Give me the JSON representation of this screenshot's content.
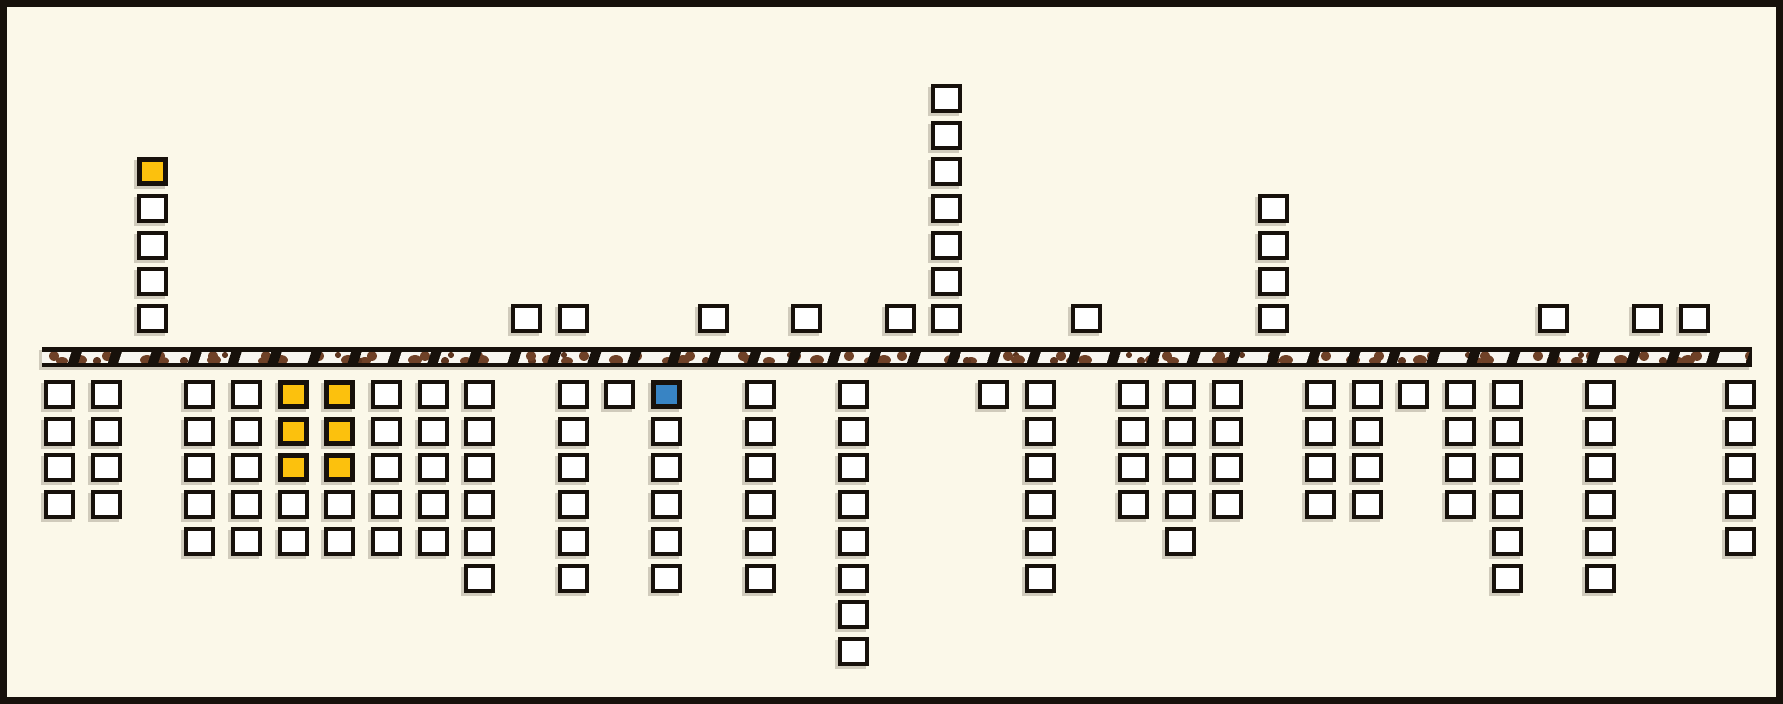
{
  "canvas": {
    "width": 1783,
    "height": 704,
    "background": "#FBF8E9",
    "frame_color": "#17110B",
    "frame_width": 7
  },
  "band": {
    "x": 35,
    "y": 340,
    "width": 1710,
    "height": 20,
    "fill": "#F8F6F0",
    "dot_color": "#6F4127",
    "dot_color_dark": "#5E3620",
    "dash_color": "#17110B"
  },
  "grid": {
    "origin_x": 37,
    "col_pitch": 46.7,
    "row_pitch": 36.7,
    "cell_w": 31,
    "cell_h": 29,
    "above_first_row_top": 297,
    "below_first_row_top": 373
  },
  "colors": {
    "W": "#FFFFFF",
    "Y": "#FCC10D",
    "B": "#3884C4"
  },
  "columns": [
    {
      "col": 0,
      "above": [],
      "below": [
        "W",
        "W",
        "W",
        "W"
      ]
    },
    {
      "col": 1,
      "above": [],
      "below": [
        "W",
        "W",
        "W",
        "W"
      ]
    },
    {
      "col": 2,
      "above": [
        "W",
        "W",
        "W",
        "W",
        "Y"
      ],
      "below": []
    },
    {
      "col": 3,
      "above": [],
      "below": [
        "W",
        "W",
        "W",
        "W",
        "W"
      ]
    },
    {
      "col": 4,
      "above": [],
      "below": [
        "W",
        "W",
        "W",
        "W",
        "W"
      ]
    },
    {
      "col": 5,
      "above": [],
      "below": [
        "Y",
        "Y",
        "Y",
        "W",
        "W"
      ]
    },
    {
      "col": 6,
      "above": [],
      "below": [
        "Y",
        "Y",
        "Y",
        "W",
        "W"
      ]
    },
    {
      "col": 7,
      "above": [],
      "below": [
        "W",
        "W",
        "W",
        "W",
        "W"
      ]
    },
    {
      "col": 8,
      "above": [],
      "below": [
        "W",
        "W",
        "W",
        "W",
        "W"
      ]
    },
    {
      "col": 9,
      "above": [],
      "below": [
        "W",
        "W",
        "W",
        "W",
        "W",
        "W"
      ]
    },
    {
      "col": 10,
      "above": [
        "W"
      ],
      "below": []
    },
    {
      "col": 11,
      "above": [
        "W"
      ],
      "below": [
        "W",
        "W",
        "W",
        "W",
        "W",
        "W"
      ]
    },
    {
      "col": 12,
      "above": [],
      "below": [
        "W"
      ]
    },
    {
      "col": 13,
      "above": [],
      "below": [
        "B",
        "W",
        "W",
        "W",
        "W",
        "W"
      ]
    },
    {
      "col": 14,
      "above": [
        "W"
      ],
      "below": []
    },
    {
      "col": 15,
      "above": [],
      "below": [
        "W",
        "W",
        "W",
        "W",
        "W",
        "W"
      ]
    },
    {
      "col": 16,
      "above": [
        "W"
      ],
      "below": []
    },
    {
      "col": 17,
      "above": [],
      "below": [
        "W",
        "W",
        "W",
        "W",
        "W",
        "W",
        "W",
        "W"
      ]
    },
    {
      "col": 18,
      "above": [
        "W"
      ],
      "below": []
    },
    {
      "col": 19,
      "above": [
        "W",
        "W",
        "W",
        "W",
        "W",
        "W",
        "W"
      ],
      "below": []
    },
    {
      "col": 20,
      "above": [],
      "below": [
        "W"
      ]
    },
    {
      "col": 21,
      "above": [],
      "below": [
        "W",
        "W",
        "W",
        "W",
        "W",
        "W"
      ]
    },
    {
      "col": 22,
      "above": [
        "W"
      ],
      "below": []
    },
    {
      "col": 23,
      "above": [],
      "below": [
        "W",
        "W",
        "W",
        "W"
      ]
    },
    {
      "col": 24,
      "above": [],
      "below": [
        "W",
        "W",
        "W",
        "W",
        "W"
      ]
    },
    {
      "col": 25,
      "above": [],
      "below": [
        "W",
        "W",
        "W",
        "W"
      ]
    },
    {
      "col": 26,
      "above": [
        "W",
        "W",
        "W",
        "W"
      ],
      "below": []
    },
    {
      "col": 27,
      "above": [],
      "below": [
        "W",
        "W",
        "W",
        "W"
      ]
    },
    {
      "col": 28,
      "above": [],
      "below": [
        "W",
        "W",
        "W",
        "W"
      ]
    },
    {
      "col": 29,
      "above": [],
      "below": [
        "W"
      ]
    },
    {
      "col": 30,
      "above": [],
      "below": [
        "W",
        "W",
        "W",
        "W"
      ]
    },
    {
      "col": 31,
      "above": [],
      "below": [
        "W",
        "W",
        "W",
        "W",
        "W",
        "W"
      ]
    },
    {
      "col": 32,
      "above": [
        "W"
      ],
      "below": []
    },
    {
      "col": 33,
      "above": [],
      "below": [
        "W",
        "W",
        "W",
        "W",
        "W",
        "W"
      ]
    },
    {
      "col": 34,
      "above": [
        "W"
      ],
      "below": []
    },
    {
      "col": 35,
      "above": [
        "W"
      ],
      "below": []
    },
    {
      "col": 36,
      "above": [],
      "below": [
        "W",
        "W",
        "W",
        "W",
        "W"
      ]
    }
  ]
}
